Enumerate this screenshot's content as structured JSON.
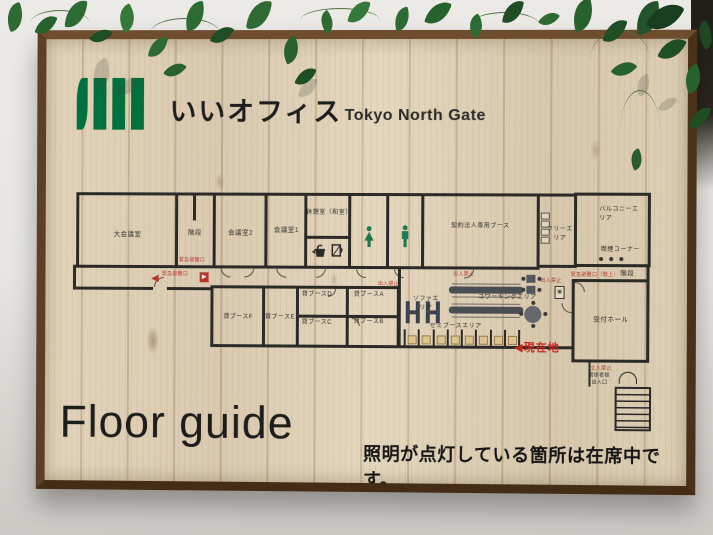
{
  "photo": {
    "brand_logo_text": "いいオフィス",
    "brand_sub_text": "Tokyo North Gate",
    "headline": "Floor guide",
    "notice": "照明が点灯している箇所は在席中です。"
  },
  "plan": {
    "rooms": {
      "large_meeting": "大会議室",
      "stairs_left": "階段",
      "meeting2": "会議室2",
      "meeting1": "会議室1",
      "rest_room": "休憩室（和室）",
      "corporate_booth": "契約法人専用ブース",
      "free_area": "フリーエリア",
      "balcony": "バルコニーエリア",
      "smoking_corner": "喫煙コーナー",
      "reception_hall": "受付ホール",
      "stairs_right": "階段"
    },
    "booths": {
      "a": "貸ブースA",
      "b": "貸ブースB",
      "c": "貸ブースC",
      "d": "貸ブースD",
      "e": "貸ブースE",
      "f": "貸ブースF"
    },
    "areas": {
      "sofa": "ソファエリア",
      "coworking": "コワーキングエリア",
      "semi_booth": "セミブースエリア"
    },
    "markers": {
      "current_arrow": "◀",
      "current_location": "現在地"
    },
    "warnings": {
      "no_entry": "出入禁止",
      "emergency_exit": "緊急避難口",
      "emergency_exit_upstairs": "緊急避難口（階上）",
      "keep_out": "立入禁止"
    },
    "entrance": {
      "line1": "関係者様",
      "line2": "出入口"
    }
  },
  "icons": {
    "current-location-arrow": "◀",
    "smoking-dots": "•••",
    "female-toilet-icon": "green female figure",
    "male-toilet-icon": "green male figure",
    "kettle-icon": "kettle silhouette",
    "cup-icon": "cup silhouette",
    "exit-icon": "red exit square ▶",
    "elevator-icon": "EV square",
    "entrance-door-icon": "double door arcs",
    "stairs-icon": "hatched treads",
    "leaf-icon": "pothos leaf shape"
  },
  "colors": {
    "logo_green": "#00713d",
    "wall_dark": "#2b2a27",
    "alert_red": "#b5372c",
    "toilet_green": "#1e7a4e",
    "wood_light": "#ddcfb5",
    "frame_brown": "#5d3f26",
    "sofa_navy": "#3d434e"
  }
}
